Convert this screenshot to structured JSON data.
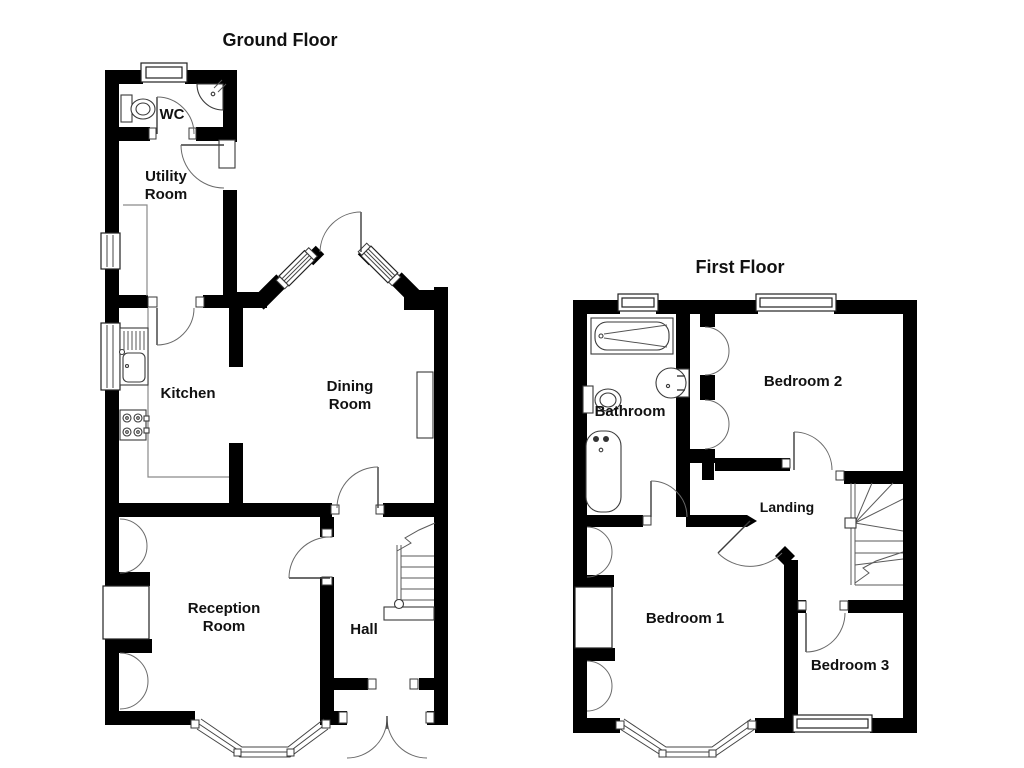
{
  "colors": {
    "background": "#ffffff",
    "wall": "#000000",
    "label": "#111111"
  },
  "ground_floor": {
    "title": "Ground Floor",
    "rooms": {
      "wc": "WC",
      "utility": [
        "Utility",
        "Room"
      ],
      "kitchen": "Kitchen",
      "dining": [
        "Dining",
        "Room"
      ],
      "reception": [
        "Reception",
        "Room"
      ],
      "hall": "Hall"
    }
  },
  "first_floor": {
    "title": "First Floor",
    "rooms": {
      "bathroom": "Bathroom",
      "bedroom2": "Bedroom 2",
      "landing": "Landing",
      "bedroom1": "Bedroom 1",
      "bedroom3": "Bedroom 3"
    }
  }
}
